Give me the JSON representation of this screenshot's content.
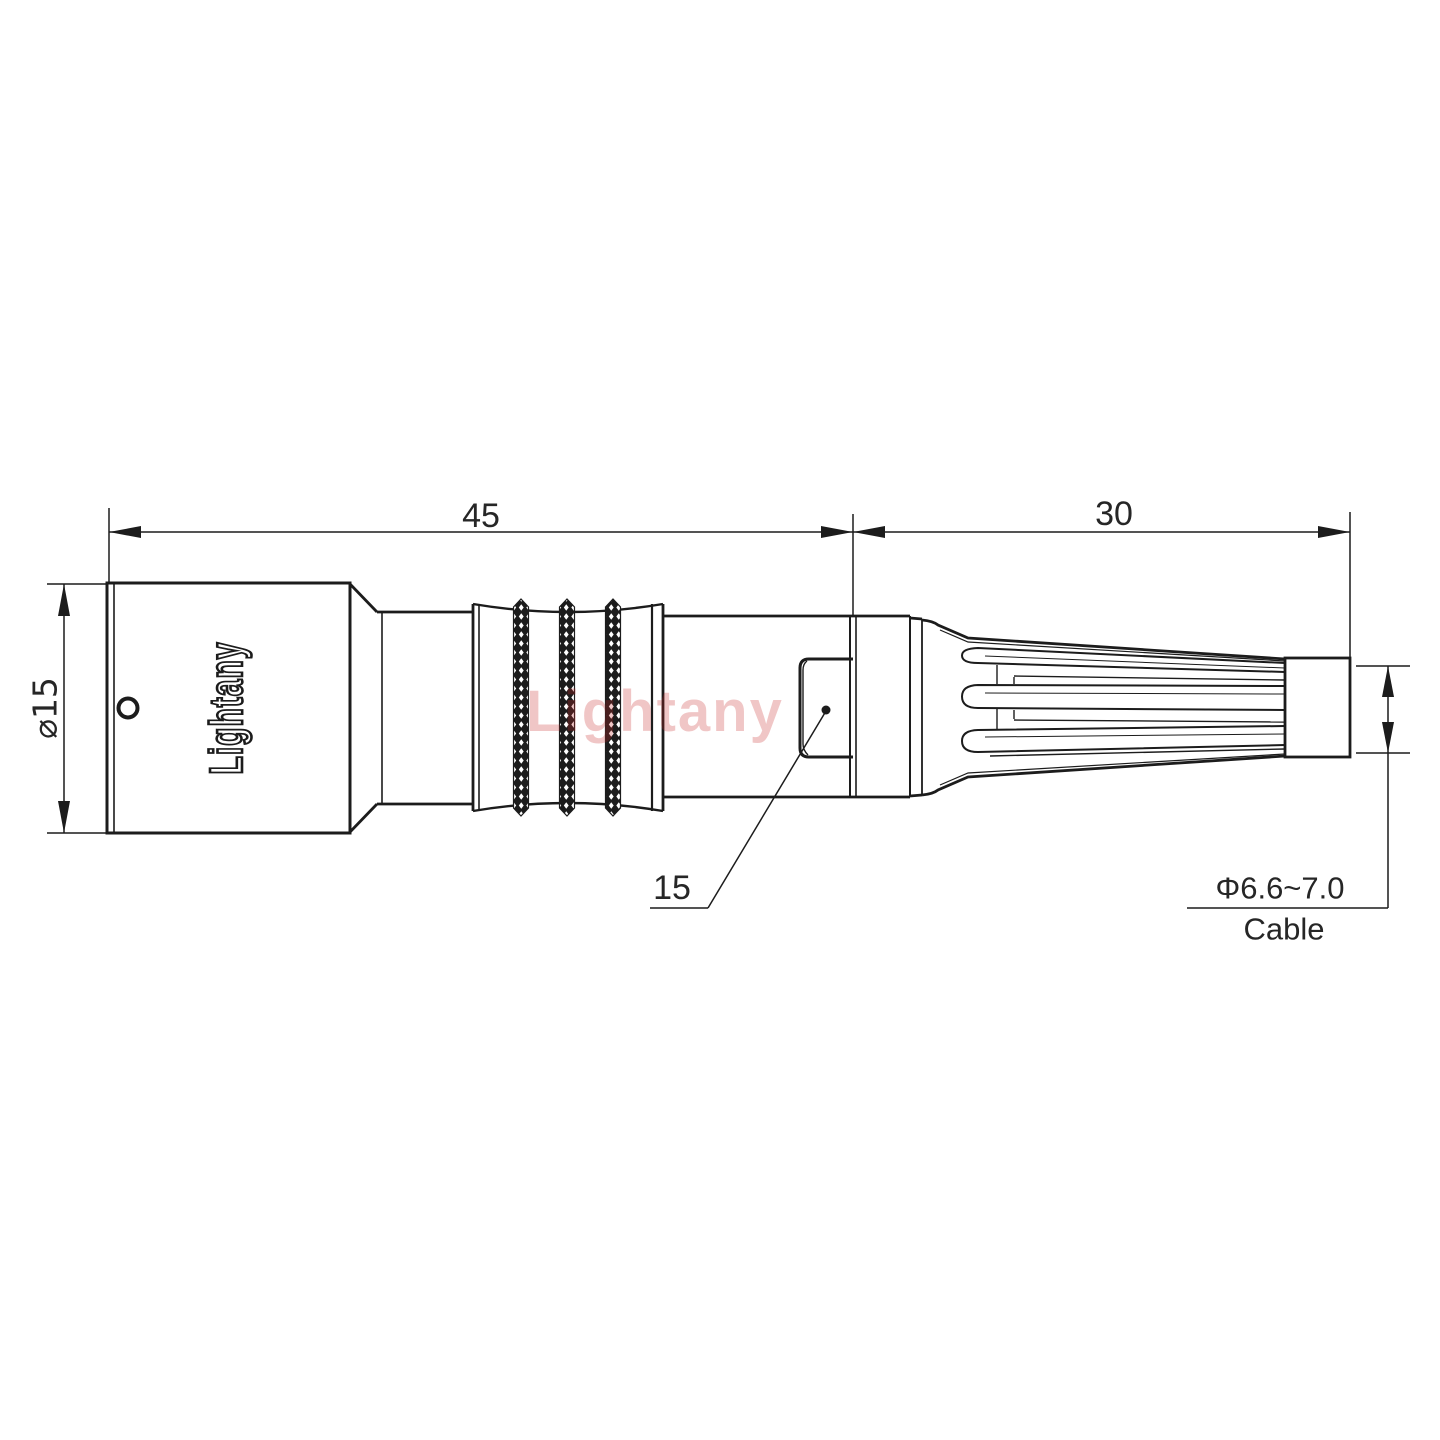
{
  "drawing": {
    "brand_engraving": "Lightany",
    "watermark": "Lightany",
    "line_color": "#1c1c1c",
    "text_color": "#262626",
    "watermark_color": "#c82828"
  },
  "dimensions": {
    "body_length": "45",
    "boot_length": "30",
    "body_diameter": "⌀15",
    "latch_ref": "15",
    "cable_diameter_range": "Φ6.6~7.0",
    "cable_label": "Cable"
  }
}
